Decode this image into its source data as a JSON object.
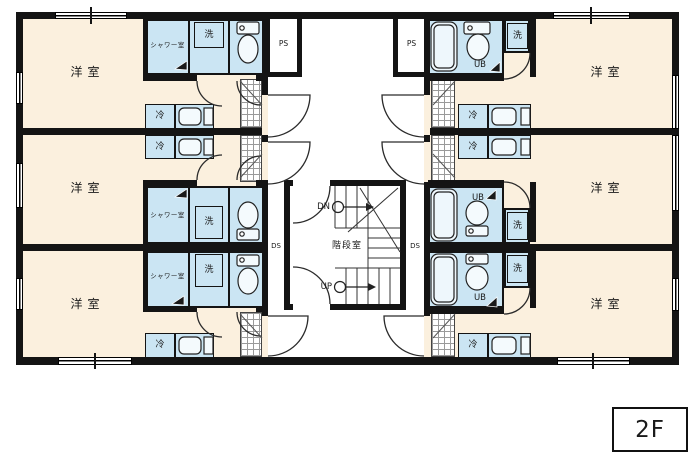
{
  "floor_indicator": "2F",
  "legend": {
    "western_room": "洋室",
    "shower_room": "シャワー室",
    "laundry": "洗",
    "refrigerator": "冷",
    "unit_bath": "UB",
    "pipe_space": "PS",
    "duct_space": "DS",
    "stairwell": "階段室",
    "stairs_down": "DN",
    "stairs_up": "UP"
  },
  "units": [
    {
      "position": "left-top",
      "rooms": [
        "洋室",
        "シャワー室",
        "洗",
        "冷"
      ]
    },
    {
      "position": "left-middle",
      "rooms": [
        "洋室",
        "シャワー室",
        "洗",
        "冷"
      ]
    },
    {
      "position": "left-bottom",
      "rooms": [
        "洋室",
        "シャワー室",
        "洗",
        "冷"
      ]
    },
    {
      "position": "right-top",
      "rooms": [
        "洋室",
        "UB",
        "洗",
        "冷"
      ]
    },
    {
      "position": "right-middle",
      "rooms": [
        "洋室",
        "UB",
        "洗",
        "冷"
      ]
    },
    {
      "position": "right-bottom",
      "rooms": [
        "洋室",
        "UB",
        "洗",
        "冷"
      ]
    }
  ],
  "core": {
    "stairwell_label": "階段室",
    "shaft_labels": [
      "PS",
      "PS",
      "DS",
      "DS"
    ],
    "stair_arrows": [
      "DN",
      "UP"
    ]
  },
  "colors": {
    "room_fill": "#fbf0de",
    "wet_area_fill": "#cbe5f3",
    "wall": "#141414",
    "corridor_fill": "#ffffff"
  }
}
